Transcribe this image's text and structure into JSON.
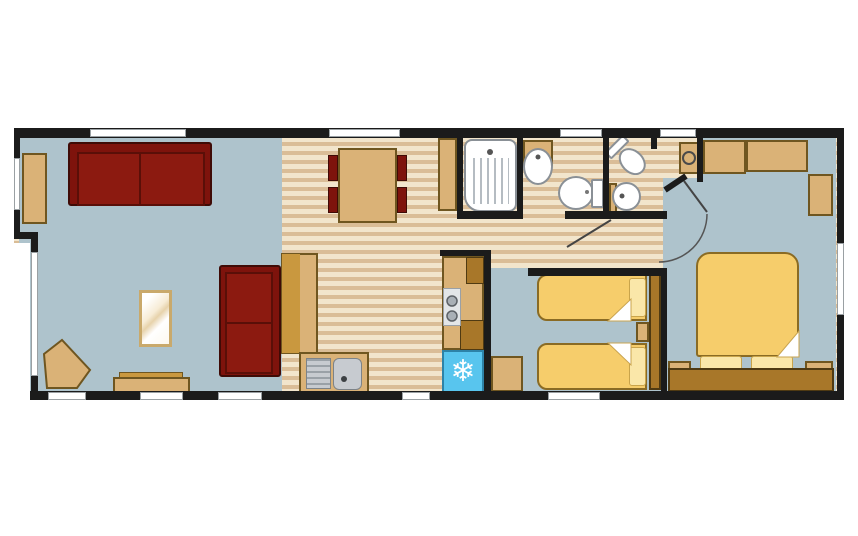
{
  "diagram": {
    "type": "floor-plan",
    "subject": "holiday-lodge-static-caravan-layout",
    "rooms": [
      {
        "name": "living-room",
        "items": [
          "sofa-two-seat",
          "sofa-two-seat",
          "coffee-table",
          "sideboard",
          "corner-table",
          "bench"
        ]
      },
      {
        "name": "kitchen-diner",
        "items": [
          "dining-table",
          "dining-chair",
          "dining-chair",
          "dining-chair",
          "dining-chair",
          "worktop",
          "sink-with-drainer",
          "hob-two-burner",
          "fridge",
          "tall-cabinet",
          "base-units"
        ]
      },
      {
        "name": "shower-room",
        "items": [
          "shower-cubicle",
          "wash-basin",
          "toilet"
        ]
      },
      {
        "name": "en-suite-wc",
        "items": [
          "toilet",
          "wash-basin",
          "vanity-basin"
        ]
      },
      {
        "name": "twin-bedroom",
        "items": [
          "single-bed",
          "single-bed",
          "bedside-unit",
          "wardrobe",
          "chest-unit"
        ]
      },
      {
        "name": "master-bedroom",
        "items": [
          "double-bed",
          "pillow",
          "pillow",
          "headboard",
          "bedside-table",
          "bedside-table",
          "overhead-unit",
          "overhead-unit",
          "wardrobe-unit"
        ]
      }
    ]
  },
  "icons": {
    "snowflake": "❄"
  },
  "colors": {
    "wall": "#1b1b1b",
    "floor-blue": "#aec3cc",
    "wood-light": "#f2e5cc",
    "wood-dark": "#dabd97",
    "tan": "#dab277",
    "tan-border": "#6f5620",
    "tan-deep": "#c9983f",
    "brown": "#a87729",
    "brown-border": "#4f3a12",
    "sofa-red": "#7e130c",
    "sofa-red-inner": "#8c1a10",
    "sofa-border": "#3f0b06",
    "bed-yellow": "#f6cd6b",
    "bed-border": "#8a6b24",
    "pillow": "#fae7a9",
    "pillow-border": "#c9a44b",
    "fridge-blue": "#58c5ee",
    "steel": "#c7cbd0",
    "steel-border": "#7d8388",
    "fixture-white": "#ffffff",
    "fixture-border": "#8a9096",
    "window-white": "#ffffff",
    "window-border": "#9aa0a3"
  }
}
